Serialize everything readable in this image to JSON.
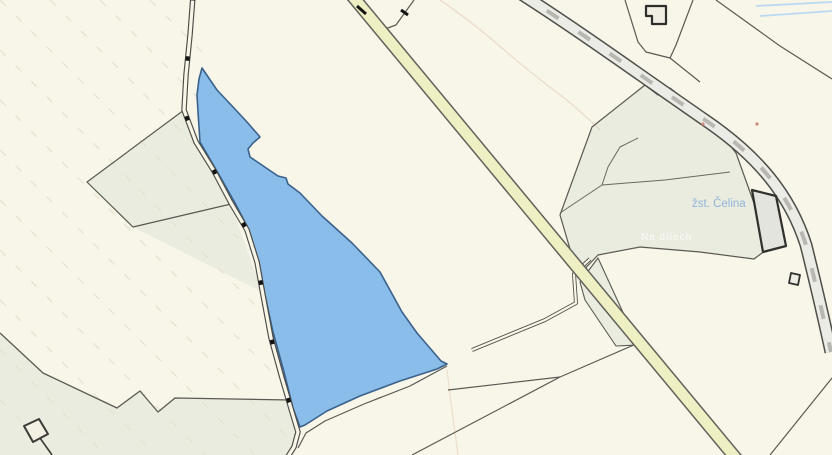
{
  "map": {
    "width": 832,
    "height": 455,
    "background": "#f8f5e9",
    "palette": {
      "vegetation_fill": "#e9ecdf",
      "boundary_line": "#5b5a52",
      "selected_parcel_fill": "#8abde9",
      "selected_parcel_stroke": "#3a628c",
      "road_fill": "#eef0c3",
      "road_edge": "#62625a",
      "railway_fill": "#ecece6",
      "railway_edge": "#4f4f49",
      "building_stroke": "#2e2e2a",
      "water_blue": "#badaf2",
      "station_label_blue": "#92b4d9",
      "hatch_tan": "#e6e3d1"
    },
    "labels": {
      "station": "žst. Čelina",
      "field": "Na dílech"
    },
    "shapes": [
      {
        "name": "vegetation-area-left",
        "kind": "path",
        "d": "M87,182 L184,110 L231,204 L262,292 L133,227 Z",
        "fill": "#e9ecdf",
        "interactable": false
      },
      {
        "name": "vegetation-area-right",
        "kind": "path",
        "d": "M580,160 L592,127 L645,85 L658,95 L670,88 L710,120 L736,153 L755,206 L766,250 L754,259 L700,252 L640,247 L598,255 L578,276 L560,215 Z",
        "fill": "#e9ecdf",
        "interactable": false
      },
      {
        "name": "vegetation-wedge-by-road",
        "kind": "path",
        "d": "M580,282 L598,258 L638,345 L616,346 L585,300 Z",
        "fill": "#e9ecdf",
        "interactable": false
      },
      {
        "name": "vegetation-area-bottom-left",
        "kind": "path",
        "d": "M0,333 L43,373 L117,408 L140,391 L158,412 L175,398 L290,400 L298,430 L291,455 L0,455 Z",
        "fill": "#e9ecdf",
        "interactable": false
      },
      {
        "name": "slope-hatch-lines",
        "kind": "path",
        "d": "M150,0 L206,56 M100,0 L221,121 M50,0 L236,186 M0,0 L251,251 M0,50 L266,316 M0,100 L281,381 M0,150 L296,446 M0,200 L255,455 M0,250 L205,455 M0,300 L155,455 M0,350 L105,455 M0,400 L55,455",
        "stroke": "#e6e3d1",
        "width": 1.3,
        "dash": "8 14",
        "interactable": false
      },
      {
        "name": "contour-line-upper",
        "kind": "path",
        "d": "M440,0 Q470,20 510,55 Q540,80 563,97 Q585,115 600,130",
        "stroke": "#c9a683",
        "width": 1.1,
        "opacity": 0.35,
        "interactable": false
      },
      {
        "name": "contour-line-lower",
        "kind": "path",
        "d": "M447,370 Q452,412 458,455",
        "stroke": "#c9a683",
        "width": 1.1,
        "opacity": 0.3,
        "interactable": false
      },
      {
        "name": "parcel-boundary-fork-left",
        "kind": "path",
        "d": "M184,110 L87,182 L133,227 L231,204",
        "stroke": "#5b5a52",
        "width": 1.2,
        "interactable": false
      },
      {
        "name": "parcel-boundary-veg-right-outline",
        "kind": "path",
        "d": "M580,160 L592,127 L645,85 L658,95 L670,88 L710,120 L736,153 L755,206 L766,250 L754,259 L700,252 L640,247 L598,255 L578,276 L560,215 Z",
        "stroke": "#5b5a52",
        "width": 1.2,
        "interactable": false
      },
      {
        "name": "parcel-boundary-wedge-outline",
        "kind": "path",
        "d": "M580,282 L598,258 L638,345 L616,346 L585,300 Z",
        "stroke": "#5b5a52",
        "width": 1.1,
        "interactable": false
      },
      {
        "name": "parcel-boundary-bottom-left",
        "kind": "path",
        "d": "M0,333 L43,373 L117,408 L140,391 L158,412 L175,398 L290,400",
        "stroke": "#5b5a52",
        "width": 1.3,
        "interactable": false
      },
      {
        "name": "vegetation-inner-boundary",
        "kind": "path",
        "d": "M560,213 L602,185 L608,167 L620,147 L638,138 M602,185 L665,180 L730,172",
        "stroke": "#6a695f",
        "width": 1,
        "interactable": false
      },
      {
        "name": "parcel-boundary-top-vertex",
        "kind": "path",
        "d": "M637,70 L645,85",
        "stroke": "#5b5a52",
        "width": 1.2,
        "interactable": false
      },
      {
        "name": "parcel-boundaries-top-center",
        "kind": "path",
        "d": "M625,0 L638,42 L646,52 L670,58 L676,45 L693,0 M670,58 L700,82",
        "stroke": "#5b5a52",
        "width": 1.2,
        "interactable": false
      },
      {
        "name": "parcel-boundary-top-right",
        "kind": "path",
        "d": "M716,0 L780,46 L832,79",
        "stroke": "#5b5a52",
        "width": 1.2,
        "interactable": false
      },
      {
        "name": "railway-side-line",
        "kind": "path",
        "d": "M526,-4 C588,32 648,74 700,112",
        "stroke": "#6a6a62",
        "width": 1,
        "interactable": false
      },
      {
        "name": "parcel-boundary-to-road-top",
        "kind": "path",
        "d": "M414,0 L396,25 L382,30",
        "stroke": "#5b5a52",
        "width": 1.2,
        "interactable": false
      },
      {
        "name": "parcel-boundary-below-parcel",
        "kind": "path",
        "d": "M447,366 L410,386 L364,404 L325,421 L306,433 L298,448",
        "stroke": "#5b5a52",
        "width": 1.2,
        "interactable": false
      },
      {
        "name": "parcel-boundary-bottom-center",
        "kind": "path",
        "d": "M412,455 L560,377 L636,344 M448,390 L560,377",
        "stroke": "#5b5a52",
        "width": 1.2,
        "interactable": false
      },
      {
        "name": "parcel-boundary-bottom-right",
        "kind": "path",
        "d": "M770,455 L832,378",
        "stroke": "#5b5a52",
        "width": 1.2,
        "interactable": false
      },
      {
        "name": "field-path-casing",
        "kind": "path",
        "d": "M472,350 L545,320 L576,303 L574,274 L590,259",
        "stroke": "#54534c",
        "width": 4,
        "interactable": false
      },
      {
        "name": "field-path-fill",
        "kind": "path",
        "d": "M472,350 L545,320 L576,303 L574,274 L590,259",
        "stroke": "#f8f5e9",
        "width": 2.2,
        "interactable": false
      },
      {
        "name": "selected-parcel",
        "kind": "path",
        "d": "M202,68 L217,90 L233,107 L247,122 L260,137 L253,143 L248,149 L250,157 L278,176 L286,178 L288,184 L300,193 L322,216 L352,243 L380,272 L402,312 L417,333 L441,361 L447,364 L437,369 L400,381 L360,396 L327,411 L305,425 L300,427 L293,408 L284,372 L273,332 L265,295 L259,262 L249,230 L235,203 L218,173 L200,142 L198,112 L197,95 L199,79 Z",
        "fill": "#8abde9",
        "stroke": "#3a628c",
        "width": 1.6,
        "interactable": true
      },
      {
        "name": "local-road-casing",
        "kind": "path",
        "d": "M193,-4 L190,35 L186,75 L184,110 L196,142 L214,171 L231,203 L247,230 L257,262 L263,295 L271,338 L282,378 L292,412 L298,432 L294,447 L287,458",
        "stroke": "#4d4c45",
        "width": 5.5,
        "interactable": false
      },
      {
        "name": "local-road-fill",
        "kind": "path",
        "d": "M193,-4 L190,35 L186,75 L184,110 L196,142 L214,171 L231,203 L247,230 L257,262 L263,295 L271,338 L282,378 L292,412 L298,432 L294,447 L287,458",
        "stroke": "#f8f5e9",
        "width": 3.2,
        "interactable": false
      },
      {
        "name": "local-road-tick-marks",
        "kind": "path",
        "d": "M193,-4 L190,35 L186,75 L184,110 L196,142 L214,171 L231,203 L247,230 L257,262 L263,295 L271,338 L282,378 L292,412 L298,432",
        "stroke": "#141414",
        "width": 4,
        "dash": "4.5 56",
        "interactable": false
      },
      {
        "name": "main-road-casing",
        "kind": "path",
        "d": "M349,-8 L739,462",
        "stroke": "#62625a",
        "width": 13.5,
        "interactable": false
      },
      {
        "name": "main-road-fill",
        "kind": "path",
        "d": "M349,-8 L739,462",
        "stroke": "#eef0c3",
        "width": 10.5,
        "interactable": false
      },
      {
        "name": "main-road-tick-1",
        "kind": "path",
        "d": "M357,6 L366,14",
        "stroke": "#151515",
        "width": 3,
        "interactable": false
      },
      {
        "name": "main-road-tick-2",
        "kind": "path",
        "d": "M401,10 L408,15",
        "stroke": "#151515",
        "width": 3,
        "interactable": false
      },
      {
        "name": "railway-casing",
        "kind": "path",
        "d": "M515,-10 C575,28 640,75 705,120 C758,156 790,195 806,245 C816,285 824,320 831,352",
        "stroke": "#4f4f49",
        "width": 13,
        "interactable": false
      },
      {
        "name": "railway-fill",
        "kind": "path",
        "d": "M515,-10 C575,28 640,75 705,120 C758,156 790,195 806,245 C816,285 824,320 831,352",
        "stroke": "#ecece6",
        "width": 10,
        "interactable": false
      },
      {
        "name": "railway-center-dashes",
        "kind": "path",
        "d": "M515,-10 C575,28 640,75 705,120 C758,156 790,195 806,245 C816,285 824,320 831,352",
        "stroke": "#b8b8b0",
        "width": 4,
        "dash": "14 24",
        "interactable": false
      },
      {
        "name": "station-label",
        "kind": "text",
        "x": 692,
        "y": 207,
        "text": "žst. Čelina",
        "fill": "#92b4d9",
        "size": 11.5,
        "interactable": false
      },
      {
        "name": "building-top",
        "kind": "path",
        "d": "M646,6 L666,6 L666,24 L652,24 L652,16 L646,16 Z",
        "fill": "#f0eee2",
        "stroke": "#2e2e2a",
        "width": 2.2,
        "interactable": false
      },
      {
        "name": "building-station",
        "kind": "path",
        "d": "M752,190 L776,196 L786,246 L763,252 Z",
        "fill": "#e4e4de",
        "stroke": "#30302c",
        "width": 2.2,
        "interactable": false
      },
      {
        "name": "building-small-right",
        "kind": "path",
        "d": "M791,273 L800,275 L798,285 L789,283 Z",
        "fill": "#f0eee2",
        "stroke": "#30302c",
        "width": 1.8,
        "interactable": false
      },
      {
        "name": "building-bottom-left",
        "kind": "path",
        "d": "M24,426 L39,419 L48,434 L33,442 Z",
        "fill": "#f3f1e4",
        "stroke": "#3a3a36",
        "width": 2,
        "interactable": false
      },
      {
        "name": "fence-bottom-left",
        "kind": "path",
        "d": "M40,438 L52,455",
        "stroke": "#3a3a36",
        "width": 1.6,
        "interactable": false
      },
      {
        "name": "stream-line-1",
        "kind": "path",
        "d": "M756,6 L832,2",
        "stroke": "#badaf2",
        "width": 1.8,
        "interactable": false
      },
      {
        "name": "stream-line-2",
        "kind": "path",
        "d": "M760,16 L832,11",
        "stroke": "#badaf2",
        "width": 1.8,
        "interactable": false
      },
      {
        "name": "survey-dot-1",
        "kind": "circle",
        "cx": 703,
        "cy": 124,
        "r": 1.6,
        "fill": "#cc8a7a",
        "interactable": false
      },
      {
        "name": "survey-dot-2",
        "kind": "circle",
        "cx": 757,
        "cy": 124,
        "r": 1.6,
        "fill": "#cc8a7a",
        "interactable": false
      },
      {
        "name": "field-name-label",
        "kind": "text",
        "x": 641,
        "y": 240,
        "text": "Na dílech",
        "fill": "#ffffff",
        "size": 10,
        "opacity": 0.8,
        "spacing": 1,
        "interactable": false
      }
    ]
  }
}
